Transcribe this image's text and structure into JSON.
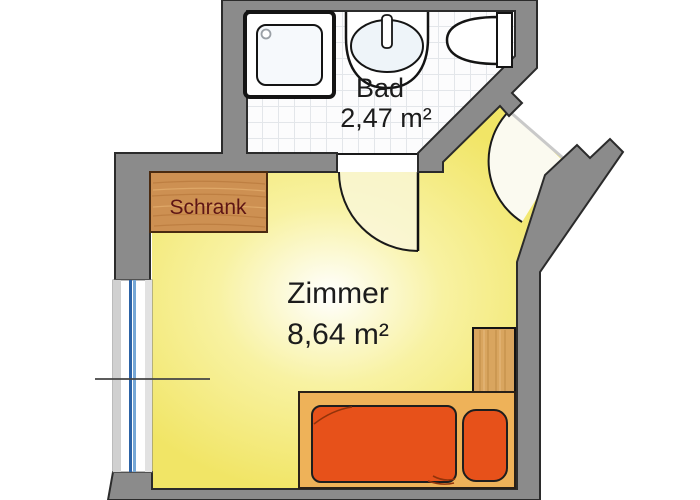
{
  "floorplan": {
    "rooms": [
      {
        "name": "Bad",
        "area": "2,47 m²"
      },
      {
        "name": "Zimmer",
        "area": "8,64 m²"
      }
    ],
    "furniture": {
      "wardrobe_label": "Schrank"
    },
    "fixtures": [
      "shower-tray",
      "washbasin",
      "toilet",
      "wardrobe",
      "bed",
      "nightstand",
      "window",
      "entrance-door",
      "interior-door"
    ],
    "colors": {
      "wall": "#8b8b8b",
      "room_floor": "#f1e566",
      "bathroom_floor": "#fcfcfd",
      "wood": "#cd9052",
      "bed_frame": "#eeb259",
      "bed_linen": "#e7511a",
      "window_glass": "#2c62a6"
    }
  }
}
